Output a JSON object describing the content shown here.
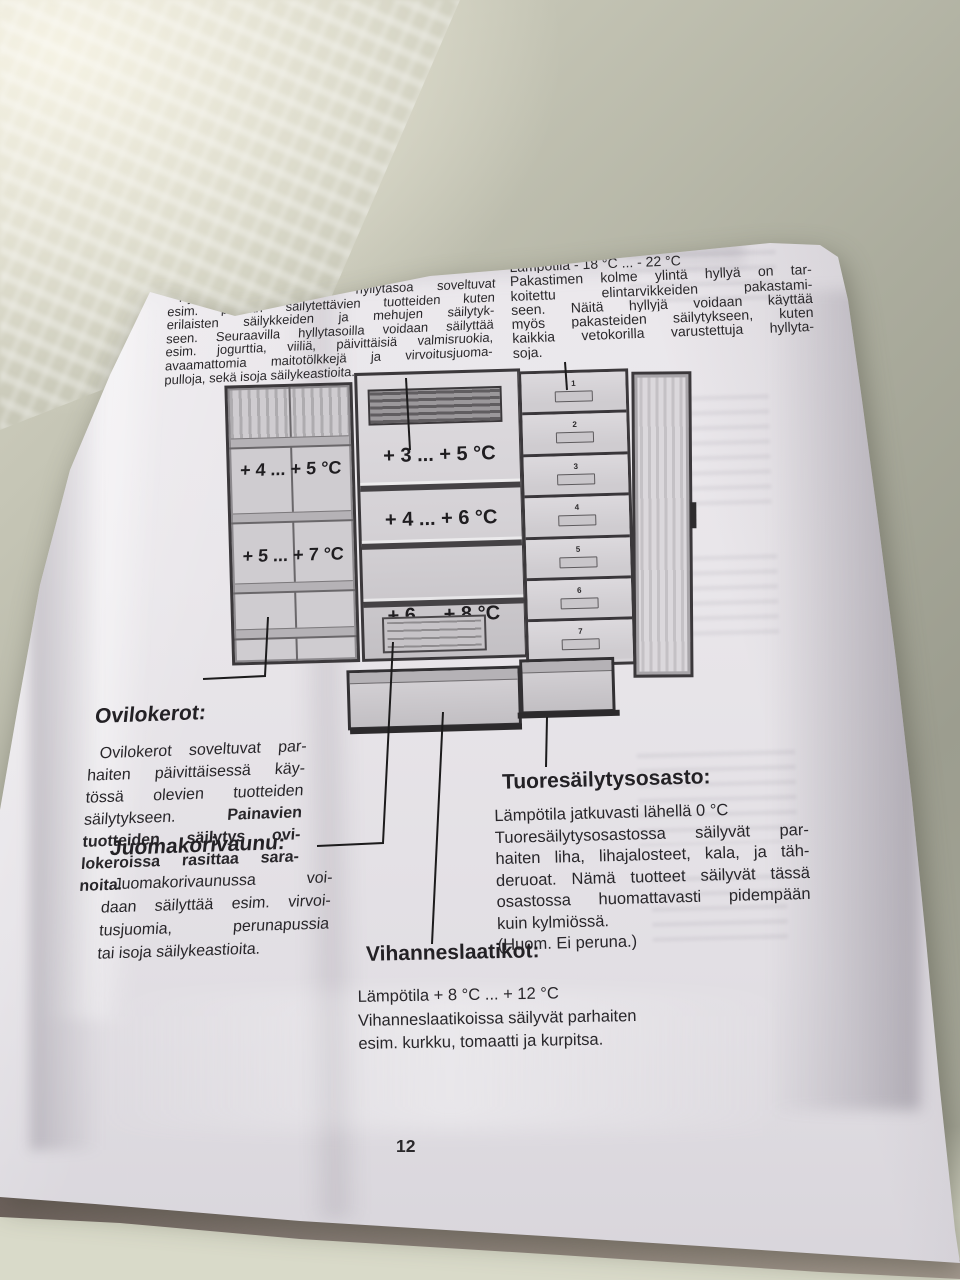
{
  "page": {
    "title": "Elintarvikkeiden säilytys",
    "page_number": "12"
  },
  "columns": {
    "left": {
      "heading": "SIJOITUSESIMERKKI",
      "subheading": "Kylmiö:",
      "lines": [
        "Kylmiön kaksi ylintä hyllytasoa soveltuvat",
        "esim. pitkään säilytettävien tuotteiden kuten",
        "erilaisten säilykkeiden ja mehujen säilytyk-",
        "seen. Seuraavilla hyllytasoilla voidaan säilyttää",
        "esim. jogurttia, viiliä, päivittäisiä valmisruokia,",
        "avaamattomia maitotölkkejä ja virvoitusjuoma-",
        "pulloja, sekä isoja säilykeastioita."
      ]
    },
    "right": {
      "heading": "Pakastin:",
      "lines": [
        "Lämpötila - 18 °C ... - 22 °C",
        "Pakastimen kolme ylintä hyllyä on tar-",
        "koitettu elintarvikkeiden pakastami-",
        "seen. Näitä hyllyjä voidaan käyttää",
        "myös pakasteiden säilytykseen, kuten",
        "kaikkia vetokorilla varustettuja hyllyta-",
        "soja."
      ]
    }
  },
  "diagram": {
    "door_temps": [
      "+ 4 ... + 5 °C",
      "+ 5 ... + 7 °C"
    ],
    "shelf_temps": [
      "+ 3 ... + 5 °C",
      "+ 4 ... + 6 °C",
      "+ 6 ... + 8 °C"
    ],
    "freezer_drawers": [
      "1",
      "2",
      "3",
      "4",
      "5",
      "6",
      "7"
    ]
  },
  "sections": {
    "ovilokerot": {
      "heading": "Ovilokerot:",
      "lines": [
        "Ovilokerot soveltuvat par-",
        "haiten päivittäisessä käy-",
        "tössä olevien tuotteiden"
      ],
      "line4_regular": "säilytykseen.",
      "line4_bold": "Painavien",
      "bold_lines": [
        "tuotteiden säilytys ovi-",
        "lokeroissa rasittaa sara-",
        "noita."
      ]
    },
    "juomakorivaunu": {
      "heading": "Juomakorivaunu:",
      "lines": [
        "Juomakorivaunussa voi-",
        "daan säilyttää esim. virvoi-",
        "tusjuomia, perunapussia",
        "tai isoja säilykeastioita."
      ]
    },
    "tuoresailytysosasto": {
      "heading": "Tuoresäilytysosasto:",
      "lines": [
        "Lämpötila jatkuvasti lähellä 0 °C",
        "Tuoresäilytysosastossa säilyvät par-",
        "haiten liha, lihajalosteet, kala, ja täh-",
        "deruoat. Nämä tuotteet säilyvät tässä",
        "osastossa huomattavasti pidempään",
        "kuin kylmiössä.",
        "(Huom. Ei peruna.)"
      ]
    },
    "vihanneslaatikot": {
      "heading": "Vihanneslaatikot:",
      "lines": [
        "Lämpötila + 8 °C ... + 12 °C",
        "Vihanneslaatikoissa säilyvät parhaiten",
        "esim. kurkku, tomaatti ja kurpitsa."
      ]
    }
  },
  "colors": {
    "title_bar": "#151415",
    "title_text": "#f1eff1",
    "body_text": "#29272a",
    "page_paper": "#eae7eb",
    "background_wall": "#a7a899",
    "diagram_outline": "#3b383b"
  }
}
